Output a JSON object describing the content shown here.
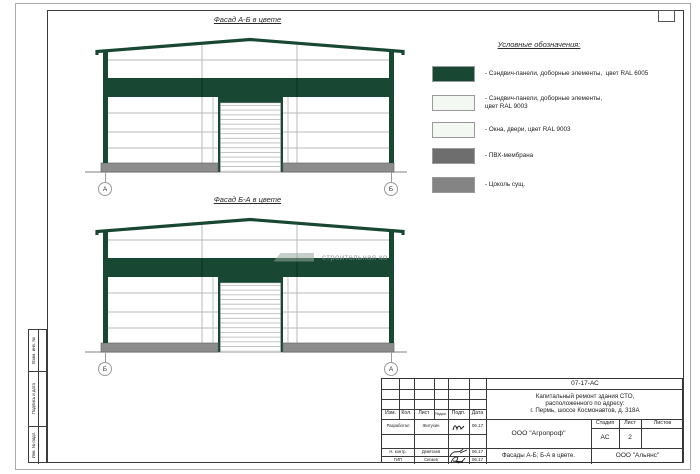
{
  "drawing": {
    "facades": [
      {
        "title": "Фасад А-Б в цвете",
        "left_marker": "А",
        "right_marker": "Б"
      },
      {
        "title": "Фасад Б-А в цвете",
        "left_marker": "Б",
        "right_marker": "А"
      }
    ],
    "watermark": "строительная ко",
    "colors": {
      "ral6005_green": "#184734",
      "ral9003_white": "#f4f8f3",
      "plinth_gray": "#8c8c8c"
    }
  },
  "legend": {
    "title": "Условные обозначения:",
    "items": [
      {
        "label": "- Сэндвич-панели, доборные элементы,  цвет RAL 6005",
        "color": "#184734"
      },
      {
        "label": "- Сэндвич-панели, доборные элементы,\nцвет RAL 9003",
        "color": "#f4f8f3"
      },
      {
        "label": "- Окна, двери, цвет RAL 9003",
        "color": "#f4f8f3"
      },
      {
        "label": "- ПВХ-мембрана",
        "color": "#6e6e6e"
      },
      {
        "label": "- Цоколь сущ.",
        "color": "#848484"
      }
    ]
  },
  "frame": {
    "side_labels": [
      "Взам. инв. №",
      "Подпись и дата",
      "Инв. № подл."
    ]
  },
  "title_block": {
    "doc_number": "07-17-АС",
    "project_lines": [
      "Капитальный ремонт здания СТО,",
      "расположенного по адресу:",
      "г. Пермь, шоссе Космонавтов, д. 318А"
    ],
    "columns": [
      "Изм.",
      "Кол.",
      "Лист",
      "№док.",
      "Подп.",
      "Дата"
    ],
    "rows": [
      {
        "role": "Разработал",
        "name": "Житухин",
        "date": "06.17"
      },
      {
        "role": "Н. контр.",
        "name": "Девятаев",
        "date": "06.17"
      },
      {
        "role": "ГИП",
        "name": "Сигаев",
        "date": "06.17"
      }
    ],
    "org": "ООО \"Агропроф\"",
    "stage_label": "Стадия",
    "sheet_label": "Лист",
    "sheets_label": "Листов",
    "stage": "АС",
    "sheet_number": "2",
    "sheet_title": "Фасады А-Б; Б-А в цвете.",
    "contractor": "ООО \"Альянс\""
  }
}
